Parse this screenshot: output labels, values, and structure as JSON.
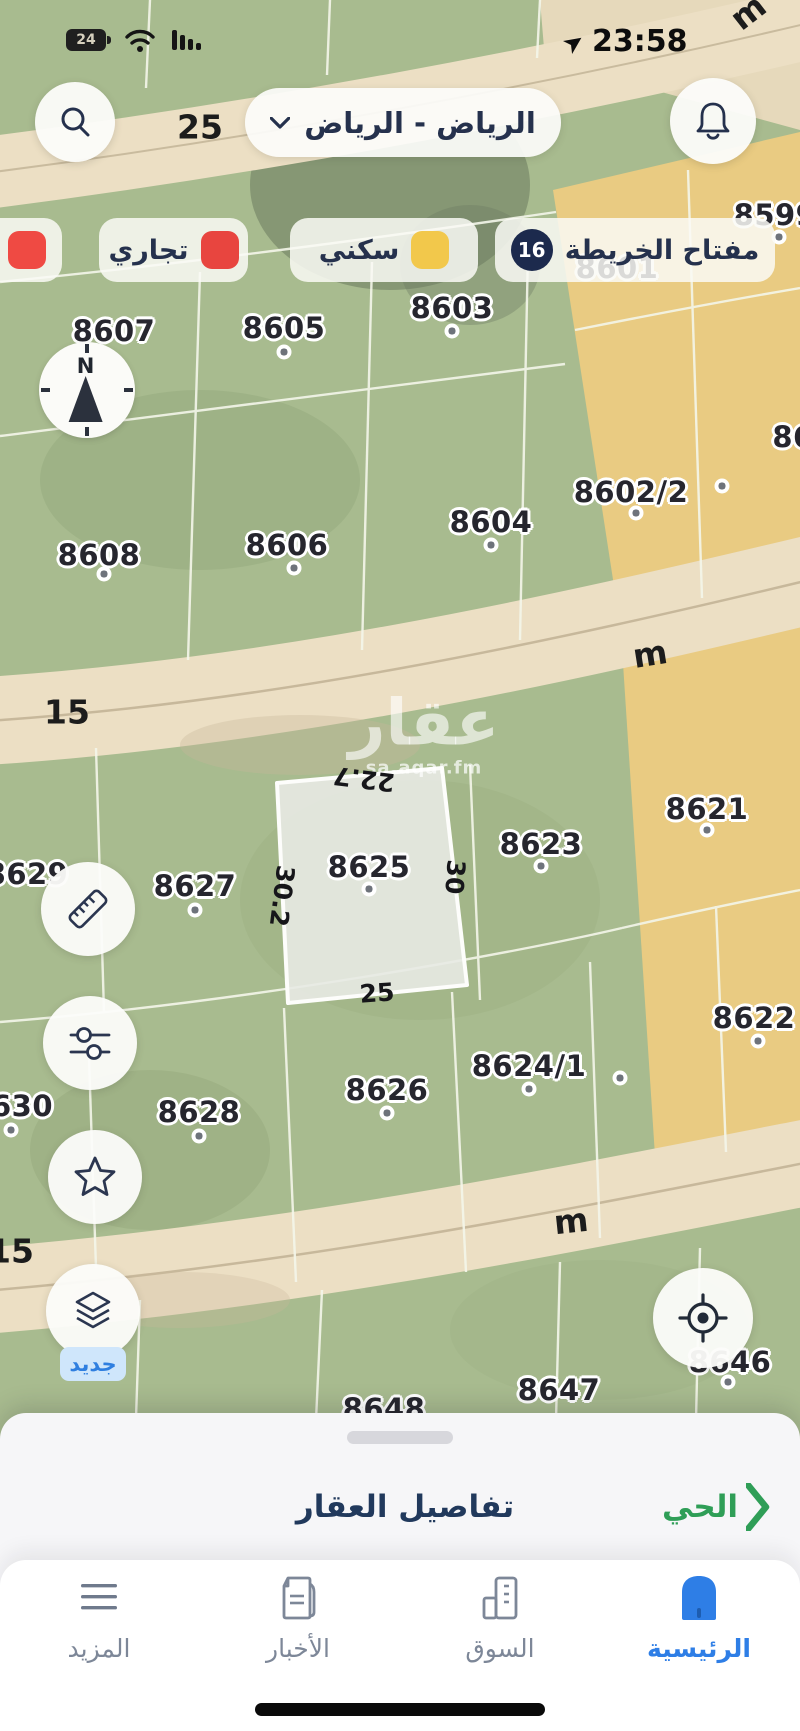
{
  "status_bar": {
    "battery": "24",
    "time": "23:58"
  },
  "header": {
    "region_selector": "الرياض - الرياض"
  },
  "legend": {
    "title": "مفتاح الخريطة",
    "count": "16",
    "items": [
      {
        "label": "سكني",
        "color": "#f2c84b"
      },
      {
        "label": "تجاري",
        "color": "#e8453f"
      },
      {
        "label": "",
        "color": "#ef4a43"
      }
    ]
  },
  "map": {
    "watermark": {
      "title": "عقار",
      "domain": "sa.aqar.fm"
    },
    "compass_north": "N",
    "street_labels": [
      "m",
      "25",
      "m",
      "15",
      "m",
      "15"
    ],
    "parcel_labels": [
      "8599",
      "8601",
      "8603",
      "8605",
      "8607",
      "86",
      "8602/2",
      "8604",
      "8606",
      "8608",
      "8621",
      "8623",
      "8625",
      "8627",
      "8629",
      "8622",
      "8624/1",
      "8626",
      "8628",
      "630",
      "8646",
      "8647",
      "8648"
    ],
    "dimensions": {
      "top": "22.7",
      "left": "30.2",
      "right": "30",
      "bottom": "25"
    },
    "new_badge": "جديد"
  },
  "bottom_sheet": {
    "details_label": "تفاصيل العقار",
    "district_label": "الحي"
  },
  "nav": {
    "items": [
      {
        "label": "الرئيسية",
        "active": true
      },
      {
        "label": "السوق",
        "active": false
      },
      {
        "label": "الأخبار",
        "active": false
      },
      {
        "label": "المزيد",
        "active": false
      }
    ]
  },
  "colors": {
    "accent_blue": "#2e7ee6",
    "navy": "#25314d",
    "green": "#2f9e57",
    "legend_yellow": "#f2c84b",
    "legend_red": "#e8453f",
    "badge_navy": "#1c2a4d",
    "map_green": "#a8bb8f",
    "map_yellow": "#e9cb82",
    "street_sand": "#ecdfc4"
  }
}
